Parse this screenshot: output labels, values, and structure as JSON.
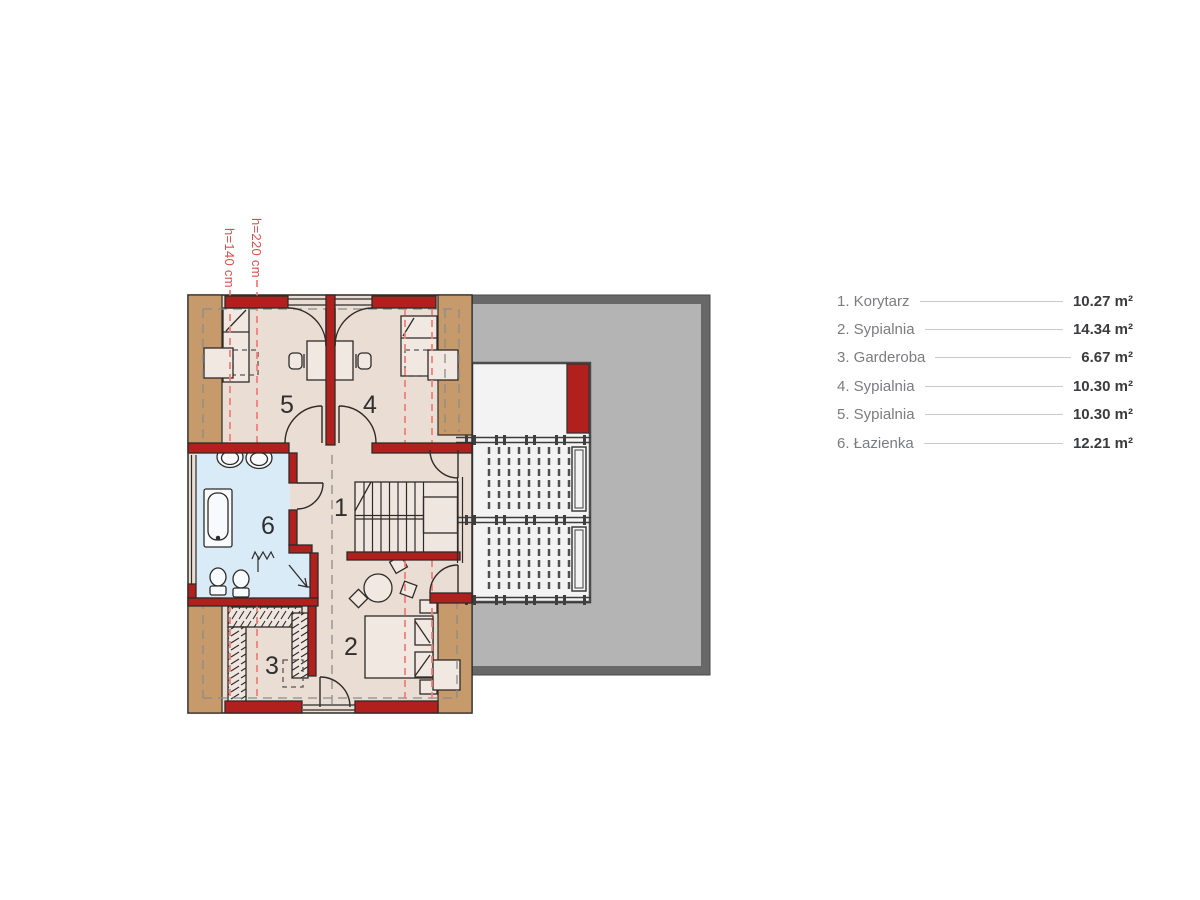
{
  "annotations": {
    "height_line_220": "h=220 cm",
    "height_line_140": "h=140 cm"
  },
  "plan": {
    "room_numbers": {
      "r1": "1",
      "r2": "2",
      "r3": "3",
      "r4": "4",
      "r5": "5",
      "r6": "6"
    }
  },
  "legend": {
    "items": [
      {
        "label": "1. Korytarz",
        "value": "10.27 m²"
      },
      {
        "label": "2. Sypialnia",
        "value": "14.34 m²"
      },
      {
        "label": "3. Garderoba",
        "value": "6.67 m²"
      },
      {
        "label": "4. Sypialnia",
        "value": "10.30 m²"
      },
      {
        "label": "5. Sypialnia",
        "value": "10.30 m²"
      },
      {
        "label": "6. Łazienka",
        "value": "12.21 m²"
      }
    ]
  },
  "colors": {
    "wall_red": "#b2201e",
    "knee_wall_tan": "#c79a6b",
    "floor_beige": "#eaddd3",
    "bathroom_blue": "#d9ebf7",
    "roof_gray": "#b4b4b4",
    "roof_border_gray": "#686868",
    "terrace_white": "#f3f3f3",
    "height_line_red": "#f0807a",
    "annotation_red": "#d95050",
    "legend_label_gray": "#7b7c7f",
    "legend_value_dark": "#3a3b3d"
  }
}
